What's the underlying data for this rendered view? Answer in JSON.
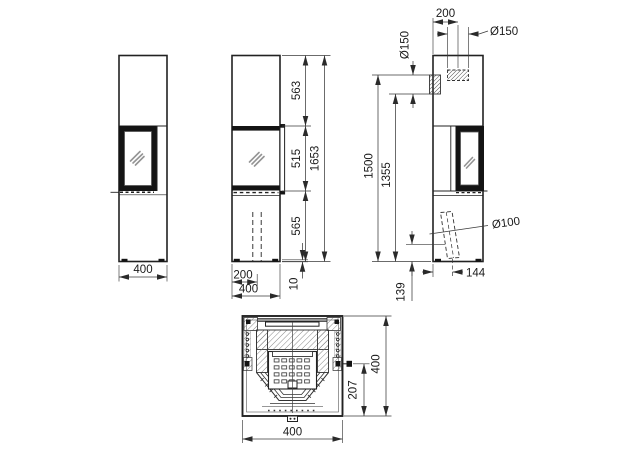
{
  "drawing": {
    "kind": "stove-technical-drawing",
    "units": "mm",
    "colors": {
      "line": "#222222",
      "dim_line": "#3a3a3a",
      "fill_dark": "#141414",
      "glass_reflection": "#949494",
      "background": "#ffffff"
    },
    "views": {
      "left": {
        "width": "400"
      },
      "front": {
        "upper_height": "563",
        "door_height": "515",
        "lower_height": "565",
        "total_height": "1653",
        "flue_offset": "200",
        "width": "400",
        "base_height": "10"
      },
      "right": {
        "top_flue_offset": "200",
        "top_flue_dia": "Ø150",
        "rear_flue_dia": "Ø150",
        "rear_flue_top_height": "1500",
        "rear_flue_bottom_height": "1355",
        "air_inlet_dia": "Ø100",
        "air_inlet_offset": "144",
        "air_inlet_height": "139"
      },
      "section": {
        "depth": "400",
        "control_offset": "207",
        "width": "400"
      }
    }
  }
}
